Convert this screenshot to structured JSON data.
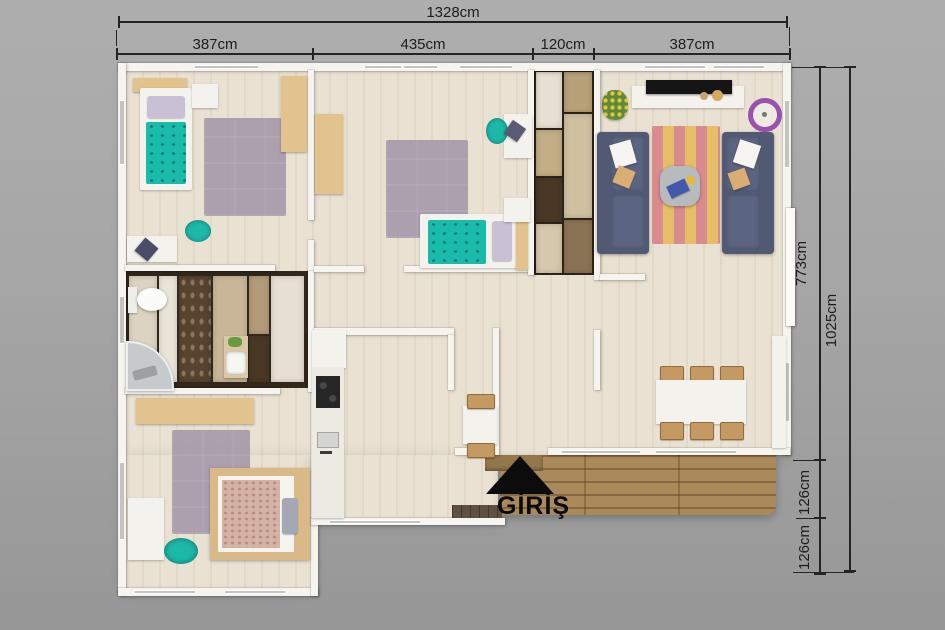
{
  "dimensions": {
    "total_width": "1328cm",
    "top_segments": [
      "387cm",
      "435cm",
      "120cm",
      "387cm"
    ],
    "right_height_main": "773cm",
    "right_bottom_segments": [
      "126cm",
      "126cm"
    ],
    "right_height_total": "1025cm"
  },
  "entrance": {
    "label": "GİRİŞ",
    "marker": "up-triangle-icon"
  },
  "palette": {
    "background_gray": "#a6a6a6",
    "wall_white": "#f6f4ee",
    "floor_wood": "#e9e1d2",
    "deck_wood": "#aa8a5b",
    "teal_accent": "#19bcab",
    "sofa_navy": "#525a73",
    "rug_mauve": "#a79aab",
    "wardrobe_tan": "#e2c28d",
    "dimension_text": "#1d1d1d",
    "entrance_marker": "#0c0c0c"
  }
}
